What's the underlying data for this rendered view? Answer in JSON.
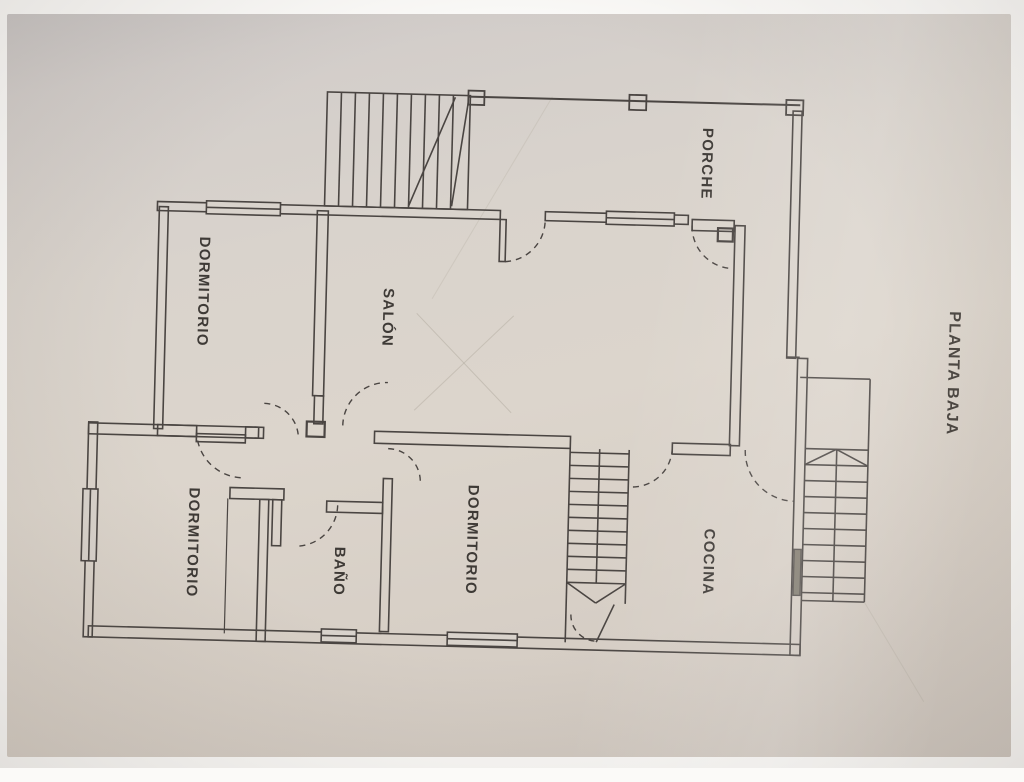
{
  "title": "PLANTA BAJA",
  "floor_plan": {
    "rooms": [
      {
        "id": "porche",
        "label": "PORCHE"
      },
      {
        "id": "salon",
        "label": "SALÓN"
      },
      {
        "id": "dormitorio-1",
        "label": "DORMITORIO"
      },
      {
        "id": "dormitorio-2",
        "label": "DORMITORIO"
      },
      {
        "id": "dormitorio-3",
        "label": "DORMITORIO"
      },
      {
        "id": "bano",
        "label": "BAÑO"
      },
      {
        "id": "cocina",
        "label": "COCINA"
      }
    ],
    "colors": {
      "paper": "#d9d3cc",
      "ink": "#4a4542"
    }
  }
}
